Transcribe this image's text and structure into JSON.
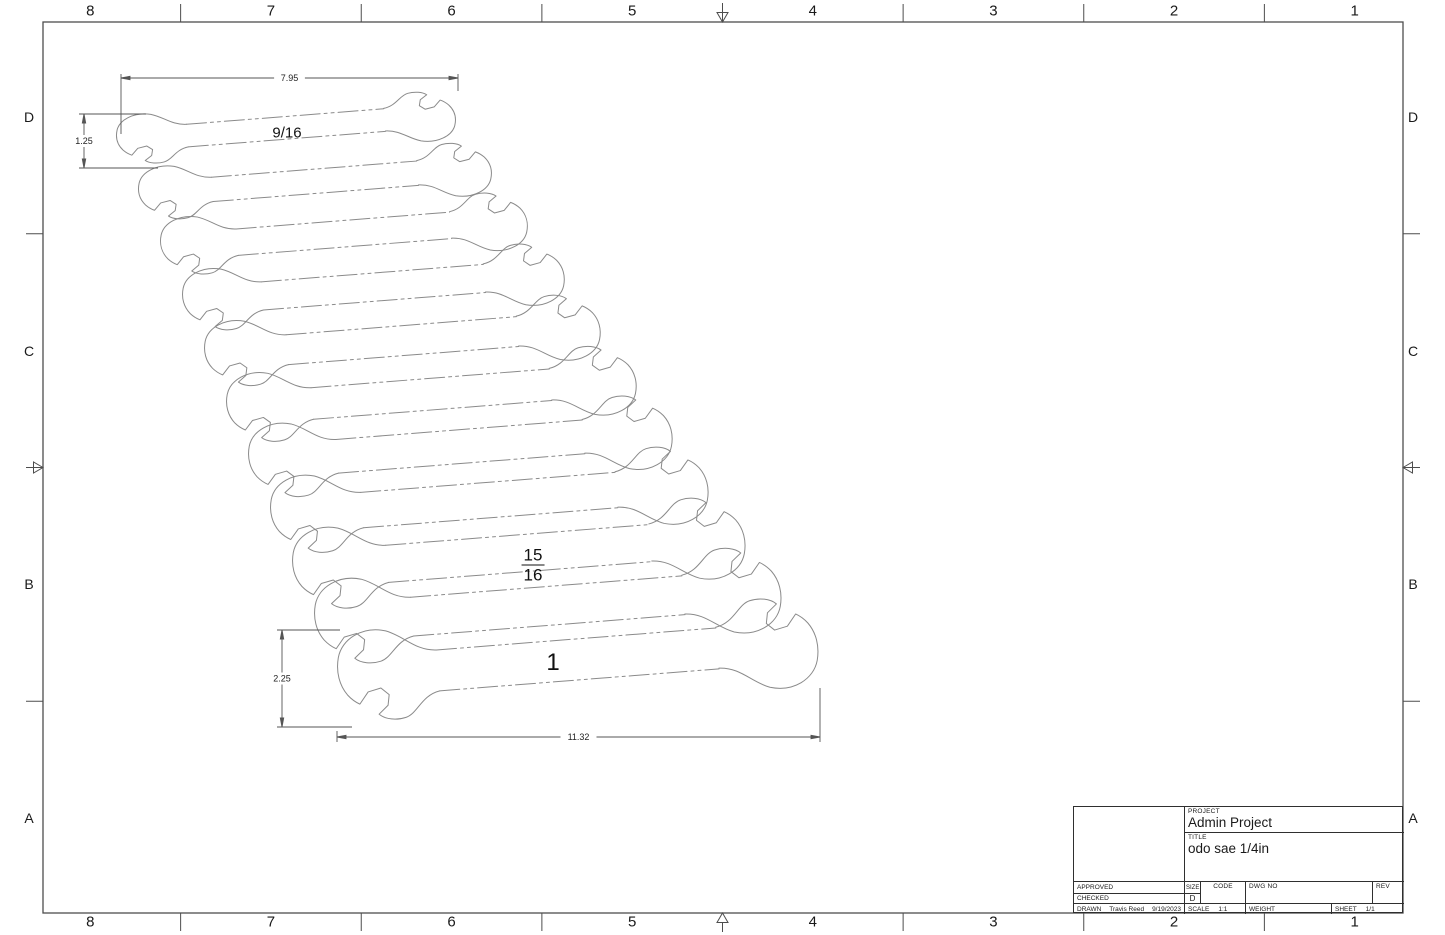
{
  "sheet": {
    "width": 1445,
    "height": 935
  },
  "colors": {
    "frame": "#4d4d4d",
    "wrench": "#8a8a8a",
    "dimension": "#555555",
    "dim_text": "#222222",
    "text": "#1a1a1a"
  },
  "frame": {
    "x1": 43,
    "y1": 22,
    "x2": 1403,
    "y2": 913
  },
  "zones": {
    "columns": [
      "8",
      "7",
      "6",
      "5",
      "4",
      "3",
      "2",
      "1"
    ],
    "rows": [
      "D",
      "C",
      "B",
      "A"
    ],
    "top_label_y": 11,
    "bottom_label_y": 922,
    "left_label_x": 29,
    "right_label_x": 1413
  },
  "drawing": {
    "rotation_deg": -4.5,
    "wrenches": [
      [
        116,
        141,
        341,
        53
      ],
      [
        138,
        195,
        355,
        57
      ],
      [
        160,
        248,
        369,
        62
      ],
      [
        182,
        302,
        384,
        66
      ],
      [
        204,
        356,
        398,
        70
      ],
      [
        226,
        410,
        412,
        74
      ],
      [
        248,
        463,
        426,
        79
      ],
      [
        270,
        517,
        440,
        83
      ],
      [
        292,
        571,
        455,
        87
      ],
      [
        314,
        624,
        469,
        91
      ],
      [
        337,
        678,
        483,
        96
      ]
    ],
    "labels": [
      {
        "kind": "text",
        "text": "9/16",
        "x": 287,
        "y": 133,
        "size": 15
      },
      {
        "kind": "fraction",
        "numerator": "15",
        "denominator": "16",
        "x": 533,
        "y": 565,
        "size": 17
      },
      {
        "kind": "text",
        "text": "1",
        "x": 553,
        "y": 663,
        "size": 24
      }
    ],
    "dimensions": [
      {
        "orient": "h",
        "label": "7.95",
        "y": 78,
        "x1": 121,
        "x2": 458,
        "ext": [
          [
            121,
            74,
            121,
            134
          ],
          [
            458,
            74,
            458,
            91
          ]
        ]
      },
      {
        "orient": "v",
        "label": "1.25",
        "x": 84,
        "y1": 114,
        "y2": 168,
        "ext": [
          [
            79,
            114,
            146,
            114
          ],
          [
            79,
            168,
            158,
            168
          ]
        ]
      },
      {
        "orient": "v",
        "label": "2.25",
        "x": 282,
        "y1": 630,
        "y2": 727,
        "ext": [
          [
            277,
            630,
            340,
            630
          ],
          [
            277,
            727,
            352,
            727
          ]
        ]
      },
      {
        "orient": "h",
        "label": "11.32",
        "y": 737,
        "x1": 337,
        "x2": 820,
        "ext": [
          [
            337,
            731,
            337,
            742
          ],
          [
            820,
            688,
            820,
            742
          ]
        ]
      }
    ]
  },
  "title_block": {
    "project_label": "PROJECT",
    "project_value": "Admin Project",
    "title_label": "TITLE",
    "title_value": "odo sae 1/4in",
    "approved_label": "APPROVED",
    "checked_label": "CHECKED",
    "drawn_label": "DRAWN",
    "drawn_name": "Travis Reed",
    "drawn_date": "9/19/2023",
    "size_label": "SIZE",
    "size_value": "D",
    "code_label": "CODE",
    "dwg_no_label": "DWG NO",
    "rev_label": "REV",
    "scale_label": "SCALE",
    "scale_value": "1:1",
    "weight_label": "WEIGHT",
    "sheet_label": "SHEET",
    "sheet_value": "1/1"
  }
}
